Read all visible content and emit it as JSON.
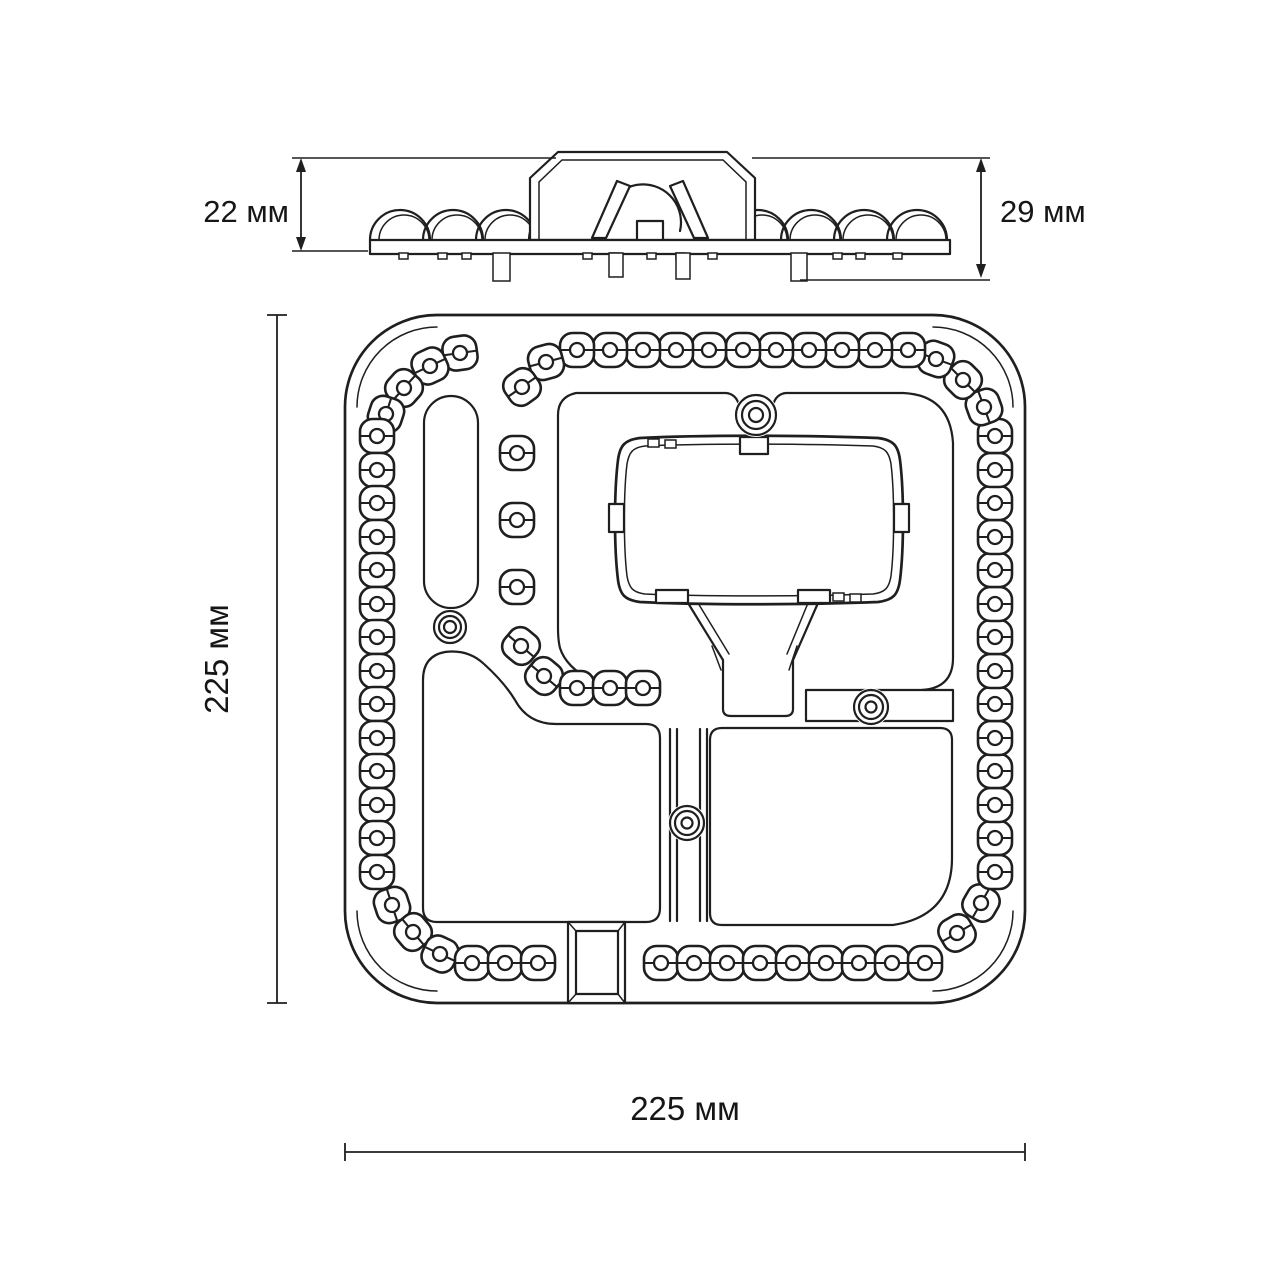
{
  "labels": {
    "side_left": "22 мм",
    "side_right": "29 мм",
    "main_left": "225 мм",
    "main_bottom": "225 мм"
  },
  "colors": {
    "line": "#1f1f1f",
    "background": "#ffffff",
    "text": "#161616"
  },
  "side_view": {
    "lens_humps": [
      400,
      453,
      506,
      559,
      758,
      811,
      864,
      917
    ],
    "hump_radius": 30,
    "plate_top_y": 240,
    "pins": [
      [
        493,
        17,
        28
      ],
      [
        609,
        14,
        24
      ],
      [
        676,
        14,
        26
      ],
      [
        791,
        16,
        28
      ]
    ],
    "feet": [
      399,
      438,
      462,
      583,
      610,
      647,
      676,
      708,
      833,
      856,
      893
    ]
  },
  "main_view": {
    "lens_size": 34,
    "lens_corner": 12.5,
    "hole_radius": 7,
    "led_ring": [
      [
        460,
        353,
        -8
      ],
      [
        430,
        366,
        -25
      ],
      [
        404,
        388,
        -48
      ],
      [
        386,
        414,
        -72
      ],
      [
        377,
        436,
        0
      ],
      [
        377,
        470,
        0
      ],
      [
        377,
        503,
        0
      ],
      [
        377,
        537,
        0
      ],
      [
        377,
        570,
        0
      ],
      [
        377,
        604,
        0
      ],
      [
        377,
        637,
        0
      ],
      [
        377,
        671,
        0
      ],
      [
        377,
        704,
        0
      ],
      [
        377,
        738,
        0
      ],
      [
        377,
        771,
        0
      ],
      [
        377,
        805,
        0
      ],
      [
        377,
        838,
        0
      ],
      [
        377,
        872,
        0
      ],
      [
        392,
        905,
        72
      ],
      [
        413,
        932,
        50
      ],
      [
        440,
        954,
        25
      ],
      [
        472,
        963,
        0
      ],
      [
        505,
        963,
        0
      ],
      [
        538,
        963,
        0
      ],
      [
        661,
        963,
        0
      ],
      [
        694,
        963,
        0
      ],
      [
        727,
        963,
        0
      ],
      [
        760,
        963,
        0
      ],
      [
        793,
        963,
        0
      ],
      [
        826,
        963,
        0
      ],
      [
        859,
        963,
        0
      ],
      [
        892,
        963,
        0
      ],
      [
        925,
        963,
        0
      ],
      [
        957,
        933,
        -30
      ],
      [
        981,
        903,
        -60
      ],
      [
        995,
        872,
        0
      ],
      [
        995,
        838,
        0
      ],
      [
        995,
        805,
        0
      ],
      [
        995,
        771,
        0
      ],
      [
        995,
        738,
        0
      ],
      [
        995,
        704,
        0
      ],
      [
        995,
        671,
        0
      ],
      [
        995,
        637,
        0
      ],
      [
        995,
        604,
        0
      ],
      [
        995,
        570,
        0
      ],
      [
        995,
        537,
        0
      ],
      [
        995,
        503,
        0
      ],
      [
        995,
        470,
        0
      ],
      [
        995,
        436,
        0
      ],
      [
        984,
        407,
        70
      ],
      [
        963,
        380,
        45
      ],
      [
        936,
        359,
        20
      ],
      [
        908,
        350,
        0
      ],
      [
        875,
        350,
        0
      ],
      [
        842,
        350,
        0
      ],
      [
        809,
        350,
        0
      ],
      [
        776,
        350,
        0
      ],
      [
        743,
        350,
        0
      ],
      [
        709,
        350,
        0
      ],
      [
        676,
        350,
        0
      ],
      [
        643,
        350,
        0
      ],
      [
        610,
        350,
        0
      ],
      [
        577,
        350,
        0
      ],
      [
        546,
        362,
        -15
      ],
      [
        522,
        387,
        -35
      ],
      [
        521,
        646,
        40
      ],
      [
        544,
        676,
        40
      ],
      [
        577,
        688,
        0
      ],
      [
        610,
        688,
        0
      ],
      [
        643,
        688,
        0
      ]
    ],
    "led_singles": [
      [
        517,
        453,
        0
      ],
      [
        517,
        520,
        0
      ],
      [
        517,
        587,
        0
      ]
    ],
    "screws": [
      [
        756,
        415,
        20,
        14,
        7
      ],
      [
        450,
        627,
        16,
        11,
        6
      ],
      [
        687,
        823,
        17,
        12,
        5.5
      ],
      [
        871,
        707,
        17,
        12,
        5.5
      ]
    ],
    "channel_wall_x": [
      670,
      677,
      700,
      707
    ]
  }
}
